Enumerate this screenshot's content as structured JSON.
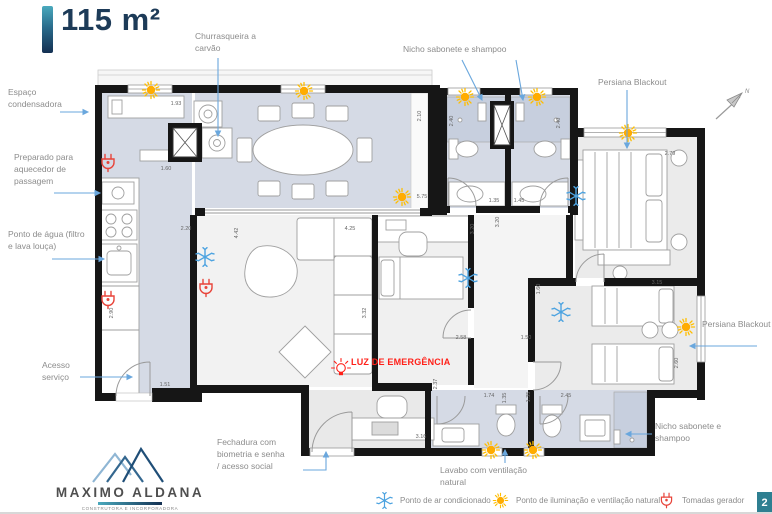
{
  "header": {
    "title": "115 m²"
  },
  "compass": {
    "north_label": "N"
  },
  "plan": {
    "emergency_label": "LUZ DE EMERGÊNCIA",
    "dimensions": [
      "1.93",
      "1.60",
      "2.20",
      "4.42",
      "2.90",
      "1.51",
      "4.25",
      "3.32",
      "2.58",
      "1.50",
      "3.16",
      "2.37",
      "1.74",
      "1.35",
      "1.35",
      "2.45",
      "3.20",
      "3.20",
      "2.40",
      "2.40",
      "1.35",
      "1.45",
      "2.10",
      "5.75",
      "2.79",
      "3.15",
      "2.60",
      "1.60"
    ]
  },
  "annotations": {
    "churrasqueira": "Churrasqueira a\ncarvão",
    "nicho_top": "Nicho sabonete e shampoo",
    "persiana_top": "Persiana Blackout",
    "persiana_right": "Persiana Blackout",
    "nicho_bottom": "Nicho sabonete e\nshampoo",
    "espaco_condensadora": "Espaço\ncondensadora",
    "aquecedor": "Preparado para\naquecedor de\npassagem",
    "ponto_agua": "Ponto de água (filtro\ne lava louça)",
    "acesso_servico": "Acesso\nserviço",
    "fechadura": "Fechadura com\nbiometria e senha\n/ acesso social",
    "lavabo": "Lavabo com ventilação\nnatural"
  },
  "legend": {
    "items": [
      {
        "icon": "snowflake-icon",
        "label": "Ponto de ar condicionado"
      },
      {
        "icon": "sun-icon",
        "label": "Ponto de iluminação e ventilação natural"
      },
      {
        "icon": "plug-icon",
        "label": "Tomadas gerador"
      }
    ]
  },
  "branding": {
    "company": "MAXIMO ALDANA",
    "tagline": "CONSTRUTORA E INCORPORADORA"
  },
  "page": {
    "number": "2"
  },
  "colors": {
    "accent_blue": "#6aa7dd",
    "ac_blue": "#4da3e0",
    "sun_yellow": "#ffb300",
    "outlet_red": "#e8443a",
    "emergency_red": "#ff2019",
    "wall_black": "#161616",
    "room_bluegray": "#d5dae5",
    "navy": "#1d3b58",
    "teal_badge": "#2e7f91"
  }
}
